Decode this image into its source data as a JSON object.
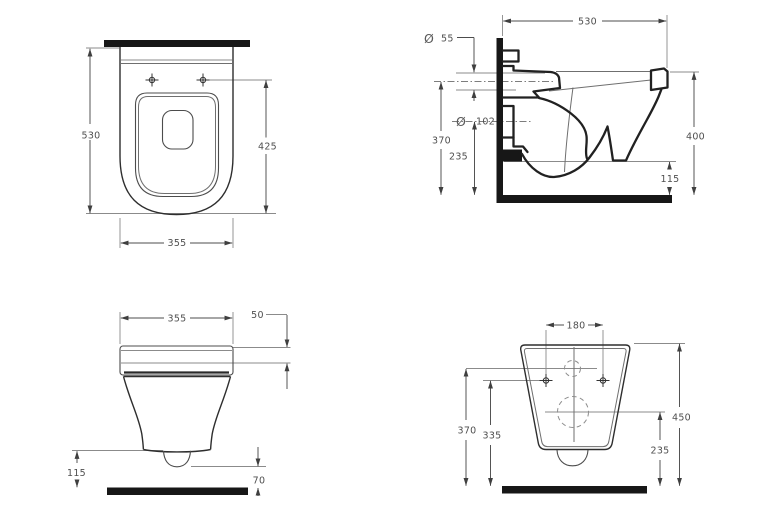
{
  "views": {
    "plan": {
      "dims": {
        "depth": "530",
        "fixing_to_front": "425",
        "width": "355"
      }
    },
    "side": {
      "dims": {
        "depth": "530",
        "inlet_dia_symbol": "Ø",
        "inlet_dia": "55",
        "inlet_height": "370",
        "outlet_dia_symbol": "Ø",
        "outlet_dia": "102",
        "outlet_height": "235",
        "height": "400",
        "clearance": "115"
      }
    },
    "front": {
      "dims": {
        "width": "355",
        "seat_thickness": "50",
        "clearance": "115",
        "outlet_clearance": "70"
      }
    },
    "rear": {
      "dims": {
        "fixing_spacing": "180",
        "inlet_height": "370",
        "fixing_height": "335",
        "height": "450",
        "outlet_height": "235"
      }
    }
  },
  "colors": {
    "wall_floor_bar": "#171717",
    "outline": "#212121",
    "thin_line": "#8b8b8b",
    "dimension_line": "#4c4c4c",
    "label_text": "#4f4f4f",
    "background": "#ffffff"
  }
}
